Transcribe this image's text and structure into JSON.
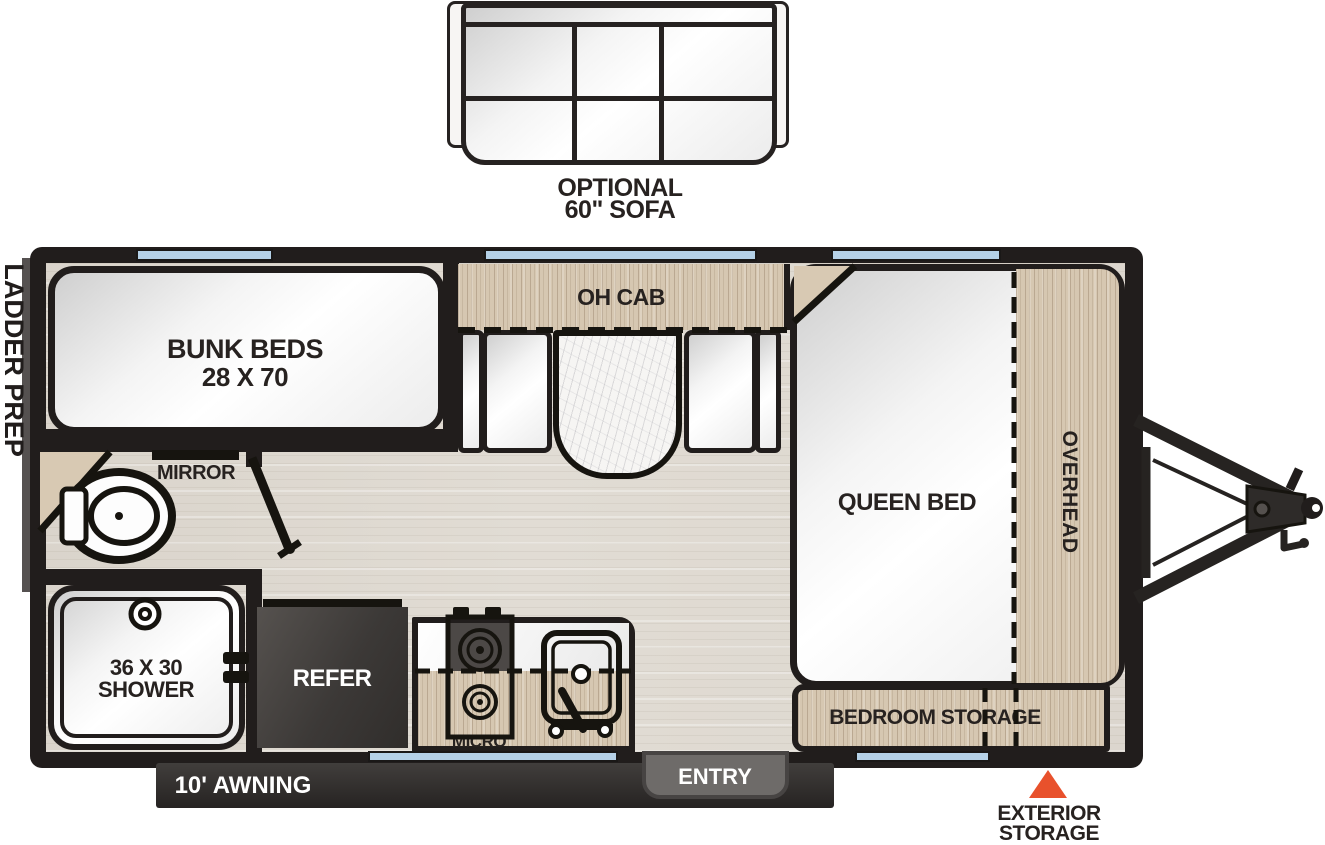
{
  "image_type": "rv-travel-trailer-floorplan",
  "labels": {
    "optional_sofa": {
      "line1": "OPTIONAL",
      "line2": "60\" SOFA"
    },
    "ladder_prep": "LADDER PREP",
    "bunk_beds": {
      "line1": "BUNK BEDS",
      "line2": "28 X 70"
    },
    "oh_cab": "OH CAB",
    "queen_bed": "QUEEN BED",
    "overhead": "OVERHEAD",
    "bedroom_storage": "BEDROOM STORAGE",
    "mirror": "MIRROR",
    "shower": {
      "line1": "36 X 30",
      "line2": "SHOWER"
    },
    "refer": "REFER",
    "micro": "MICRO",
    "entry": "ENTRY",
    "awning": "10' AWNING",
    "exterior_storage": {
      "line1": "EXTERIOR",
      "line2": "STORAGE"
    }
  },
  "colors": {
    "wall": "#211d1c",
    "wood": "#d6c7b1",
    "floor": "#e1dcd4",
    "window_blue": "#b5d1e7",
    "accent_orange": "#e8512c",
    "entry_gray": "#6e6b69",
    "awning_dark": "#2e2b2a",
    "refer_dark": "#3c3937",
    "furniture_white": "#f5f5f5",
    "text_dark": "#272220"
  }
}
